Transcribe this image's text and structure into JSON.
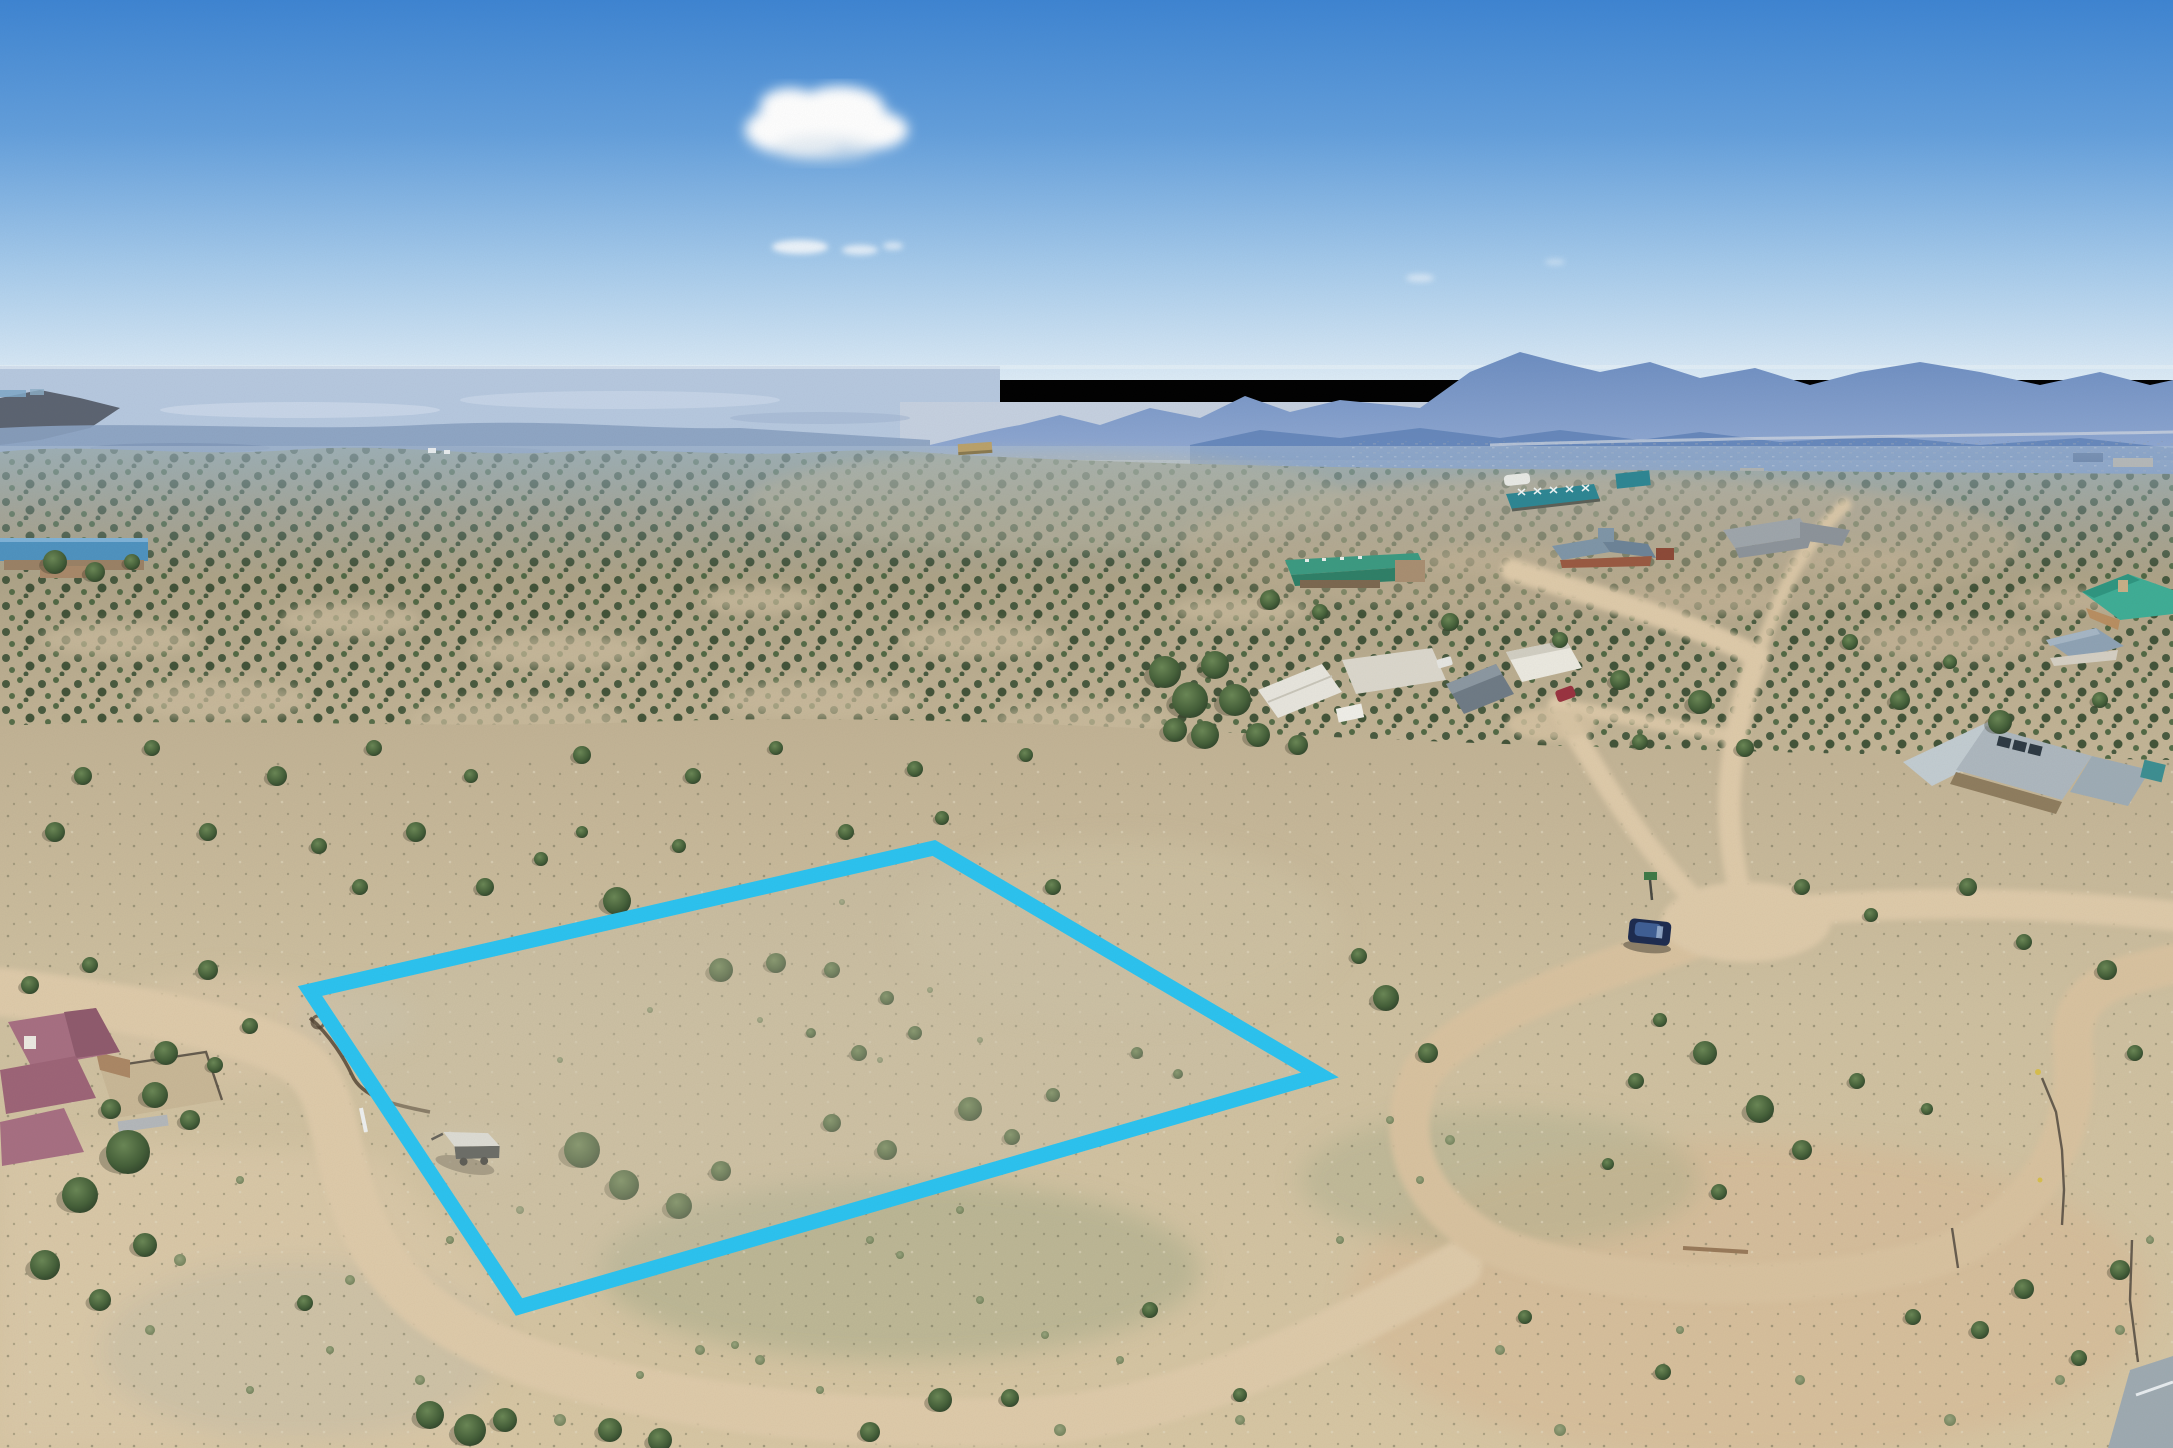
{
  "scene": {
    "description": "Aerial drone photo of high-desert lot with cyan property boundary overlay, juniper-dotted hills, dirt roads, distant mountains under blue sky",
    "width_px": 2173,
    "height_px": 1448
  },
  "boundary": {
    "label": "property-boundary-overlay",
    "color": "#2bc3f0",
    "stroke_width": 15,
    "points": "934,848 1320,1075 519,1307 310,991"
  },
  "palette": {
    "sky_top": "#3e85d3",
    "sky_horizon": "#ddecf7",
    "cloud_white": "#ffffff",
    "mountains_far": "#7e9cc9",
    "mountains_near": "#5b7fb5",
    "plains_haze": "#b7c9e0",
    "valley_haze": "#c6d1e1",
    "hills_far": "#8e9c88",
    "hills_mid": "#b3a78b",
    "foreground_sand": "#cfc1a1",
    "dirt_road": "#dfcbaa",
    "juniper_green": "#3d5634",
    "sage_green": "#8a9671",
    "boundary_cyan": "#2bc3f0"
  },
  "objects": {
    "left_building": {
      "label": "blue-roof building",
      "roof": "#4f93c0",
      "wall": "#9b8266"
    },
    "tan_hut": {
      "label": "small tan hut",
      "roof": "#bba26b"
    },
    "teal_barn": {
      "label": "teal lattice-roof barn",
      "roof": "#2e8794"
    },
    "teal_shed": {
      "label": "teal shed",
      "roof": "#2e8794"
    },
    "white_tent": {
      "label": "white tent",
      "roof": "#e9eae6"
    },
    "teal_ranch": {
      "label": "teal-roof stone ranch house",
      "roof": "#3c9b82",
      "roof_shade": "#2f8068",
      "wall": "#7c6850",
      "wing": "#a98f72"
    },
    "gray_ranch": {
      "label": "gray-roof ranch house",
      "roof": "#9fa6ac",
      "roof_shade": "#8d949b"
    },
    "red_house": {
      "label": "red house with blue-gray roofs",
      "roof": "#7f96a8",
      "roof_shade": "#6d8498",
      "wall": "#9a5a42"
    },
    "aqua_house": {
      "label": "aqua hip-roof adobe house",
      "roof": "#3fae96",
      "roof_shade": "#2f9681",
      "wall": "#b98f62"
    },
    "blue_gable_house": {
      "label": "blue-gray gable house",
      "roof": "#8fa3b5",
      "wall": "#d6d0c4"
    },
    "compound": {
      "label": "white modern compound",
      "white": "#e8e6de",
      "flat": "#dcd8cd",
      "gray_roof": "#6f7b86",
      "white2": "#eceae1"
    },
    "metal_house": {
      "label": "standing-seam metal roof house",
      "roof": "#aeb8bf",
      "roof2": "#c3cdd2",
      "panel": "#2e3a44",
      "wall": "#8f7d5f",
      "accent": "#3d8f92"
    },
    "corner_building": {
      "label": "gray-roof building bottom-right",
      "roof": "#9fabb2"
    },
    "purple_house": {
      "label": "mauve-roof adobe house",
      "roof": "#a76f82",
      "roof_shade": "#8f5a6d",
      "chimney": "#ece9e2",
      "courtyard": "#c9b897"
    },
    "trailer": {
      "label": "utility trailer with white tarp",
      "tarp": "#e9ecec",
      "body": "#3c4246"
    },
    "suv": {
      "label": "dark blue SUV on road",
      "body": "#1d2c50",
      "roof": "#3f5f95"
    },
    "red_car": {
      "label": "maroon car at compound",
      "body": "#9a3340"
    },
    "street_sign": {
      "label": "green street sign",
      "color": "#3f7a47"
    }
  },
  "vegetation": {
    "trees": [
      [
        83,
        776,
        9
      ],
      [
        152,
        748,
        8
      ],
      [
        277,
        776,
        10
      ],
      [
        374,
        748,
        8
      ],
      [
        471,
        776,
        7
      ],
      [
        582,
        755,
        9
      ],
      [
        693,
        776,
        8
      ],
      [
        776,
        748,
        7
      ],
      [
        915,
        769,
        8
      ],
      [
        1026,
        755,
        7
      ],
      [
        55,
        832,
        10
      ],
      [
        208,
        832,
        9
      ],
      [
        319,
        846,
        8
      ],
      [
        582,
        832,
        6
      ],
      [
        679,
        846,
        7
      ],
      [
        416,
        832,
        10
      ],
      [
        360,
        887,
        8
      ],
      [
        485,
        887,
        9
      ],
      [
        541,
        859,
        7
      ],
      [
        846,
        832,
        8
      ],
      [
        942,
        818,
        7
      ],
      [
        1053,
        887,
        8
      ],
      [
        617,
        901,
        14
      ],
      [
        721,
        970,
        12
      ],
      [
        776,
        963,
        10
      ],
      [
        832,
        970,
        8
      ],
      [
        887,
        998,
        7
      ],
      [
        811,
        1033,
        5
      ],
      [
        859,
        1053,
        8
      ],
      [
        915,
        1033,
        7
      ],
      [
        582,
        1150,
        18
      ],
      [
        624,
        1185,
        15
      ],
      [
        679,
        1206,
        13
      ],
      [
        721,
        1171,
        10
      ],
      [
        832,
        1123,
        9
      ],
      [
        887,
        1150,
        10
      ],
      [
        970,
        1109,
        12
      ],
      [
        1012,
        1137,
        8
      ],
      [
        1053,
        1095,
        7
      ],
      [
        1137,
        1053,
        6
      ],
      [
        1178,
        1074,
        5
      ],
      [
        1386,
        998,
        13
      ],
      [
        1428,
        1053,
        10
      ],
      [
        1359,
        956,
        8
      ],
      [
        208,
        970,
        10
      ],
      [
        250,
        1026,
        8
      ],
      [
        166,
        1053,
        12
      ],
      [
        111,
        1109,
        10
      ],
      [
        1636,
        1081,
        8
      ],
      [
        1705,
        1053,
        12
      ],
      [
        1760,
        1109,
        14
      ],
      [
        1802,
        1150,
        10
      ],
      [
        1857,
        1081,
        8
      ],
      [
        1927,
        1109,
        6
      ],
      [
        1719,
        1192,
        8
      ],
      [
        1608,
        1164,
        6
      ],
      [
        1660,
        1020,
        7
      ],
      [
        2107,
        970,
        10
      ],
      [
        2135,
        1053,
        8
      ],
      [
        1802,
        887,
        8
      ],
      [
        1871,
        915,
        7
      ],
      [
        1968,
        887,
        9
      ],
      [
        2024,
        942,
        8
      ],
      [
        430,
        1415,
        14
      ],
      [
        470,
        1430,
        16
      ],
      [
        505,
        1420,
        12
      ],
      [
        610,
        1430,
        12
      ],
      [
        660,
        1440,
        12
      ],
      [
        305,
        1303,
        8
      ],
      [
        940,
        1400,
        12
      ],
      [
        1010,
        1398,
        9
      ],
      [
        870,
        1432,
        10
      ],
      [
        1150,
        1310,
        8
      ],
      [
        1240,
        1395,
        7
      ],
      [
        2024,
        1289,
        10
      ],
      [
        2079,
        1358,
        8
      ],
      [
        1913,
        1317,
        8
      ],
      [
        1525,
        1317,
        7
      ],
      [
        1663,
        1372,
        8
      ],
      [
        2120,
        1270,
        10
      ],
      [
        1980,
        1330,
        9
      ],
      [
        1165,
        672,
        16
      ],
      [
        1190,
        700,
        18
      ],
      [
        1215,
        665,
        14
      ],
      [
        1235,
        700,
        16
      ],
      [
        1205,
        735,
        14
      ],
      [
        1175,
        730,
        12
      ],
      [
        1258,
        735,
        12
      ],
      [
        1298,
        745,
        10
      ],
      [
        1270,
        600,
        10
      ],
      [
        1320,
        612,
        8
      ],
      [
        1450,
        622,
        9
      ],
      [
        1560,
        640,
        8
      ],
      [
        1620,
        680,
        10
      ],
      [
        1700,
        702,
        12
      ],
      [
        1900,
        700,
        10
      ],
      [
        2000,
        722,
        12
      ],
      [
        2100,
        700,
        8
      ],
      [
        1850,
        642,
        8
      ],
      [
        1950,
        662,
        7
      ],
      [
        1745,
        748,
        9
      ],
      [
        1640,
        742,
        8
      ],
      [
        128,
        1152,
        22
      ],
      [
        80,
        1195,
        18
      ],
      [
        155,
        1095,
        13
      ],
      [
        45,
        1265,
        15
      ],
      [
        145,
        1245,
        12
      ],
      [
        100,
        1300,
        11
      ],
      [
        190,
        1120,
        10
      ],
      [
        215,
        1065,
        8
      ],
      [
        30,
        985,
        9
      ],
      [
        90,
        965,
        8
      ],
      [
        55,
        562,
        12
      ],
      [
        95,
        572,
        10
      ],
      [
        132,
        562,
        8
      ]
    ],
    "bushes": [
      [
        180,
        1260,
        6
      ],
      [
        420,
        1380,
        5
      ],
      [
        560,
        1420,
        6
      ],
      [
        760,
        1360,
        5
      ],
      [
        980,
        1300,
        4
      ],
      [
        1060,
        1430,
        6
      ],
      [
        1240,
        1420,
        5
      ],
      [
        1500,
        1350,
        5
      ],
      [
        1560,
        1430,
        6
      ],
      [
        1800,
        1380,
        5
      ],
      [
        1950,
        1420,
        6
      ],
      [
        2060,
        1380,
        5
      ],
      [
        1340,
        1240,
        4
      ],
      [
        870,
        1240,
        4
      ],
      [
        960,
        1210,
        4
      ],
      [
        350,
        1280,
        5
      ],
      [
        240,
        1180,
        4
      ],
      [
        2120,
        1330,
        5
      ],
      [
        1680,
        1330,
        4
      ],
      [
        1420,
        1180,
        4
      ],
      [
        700,
        1350,
        5
      ],
      [
        640,
        1375,
        4
      ],
      [
        820,
        1390,
        4
      ],
      [
        1120,
        1360,
        4
      ],
      [
        900,
        1255,
        4
      ],
      [
        735,
        1345,
        4
      ],
      [
        1390,
        1120,
        4
      ],
      [
        1450,
        1140,
        5
      ],
      [
        2150,
        1240,
        4
      ],
      [
        1045,
        1335,
        4
      ],
      [
        330,
        1350,
        4
      ],
      [
        150,
        1330,
        5
      ],
      [
        250,
        1390,
        4
      ],
      [
        520,
        1210,
        4
      ],
      [
        450,
        1240,
        4
      ],
      [
        700,
        900,
        3
      ],
      [
        760,
        1020,
        3
      ],
      [
        880,
        1060,
        3
      ],
      [
        842,
        902,
        3
      ],
      [
        980,
        1040,
        3
      ],
      [
        930,
        990,
        3
      ],
      [
        650,
        1010,
        3
      ],
      [
        560,
        1060,
        3
      ]
    ]
  }
}
